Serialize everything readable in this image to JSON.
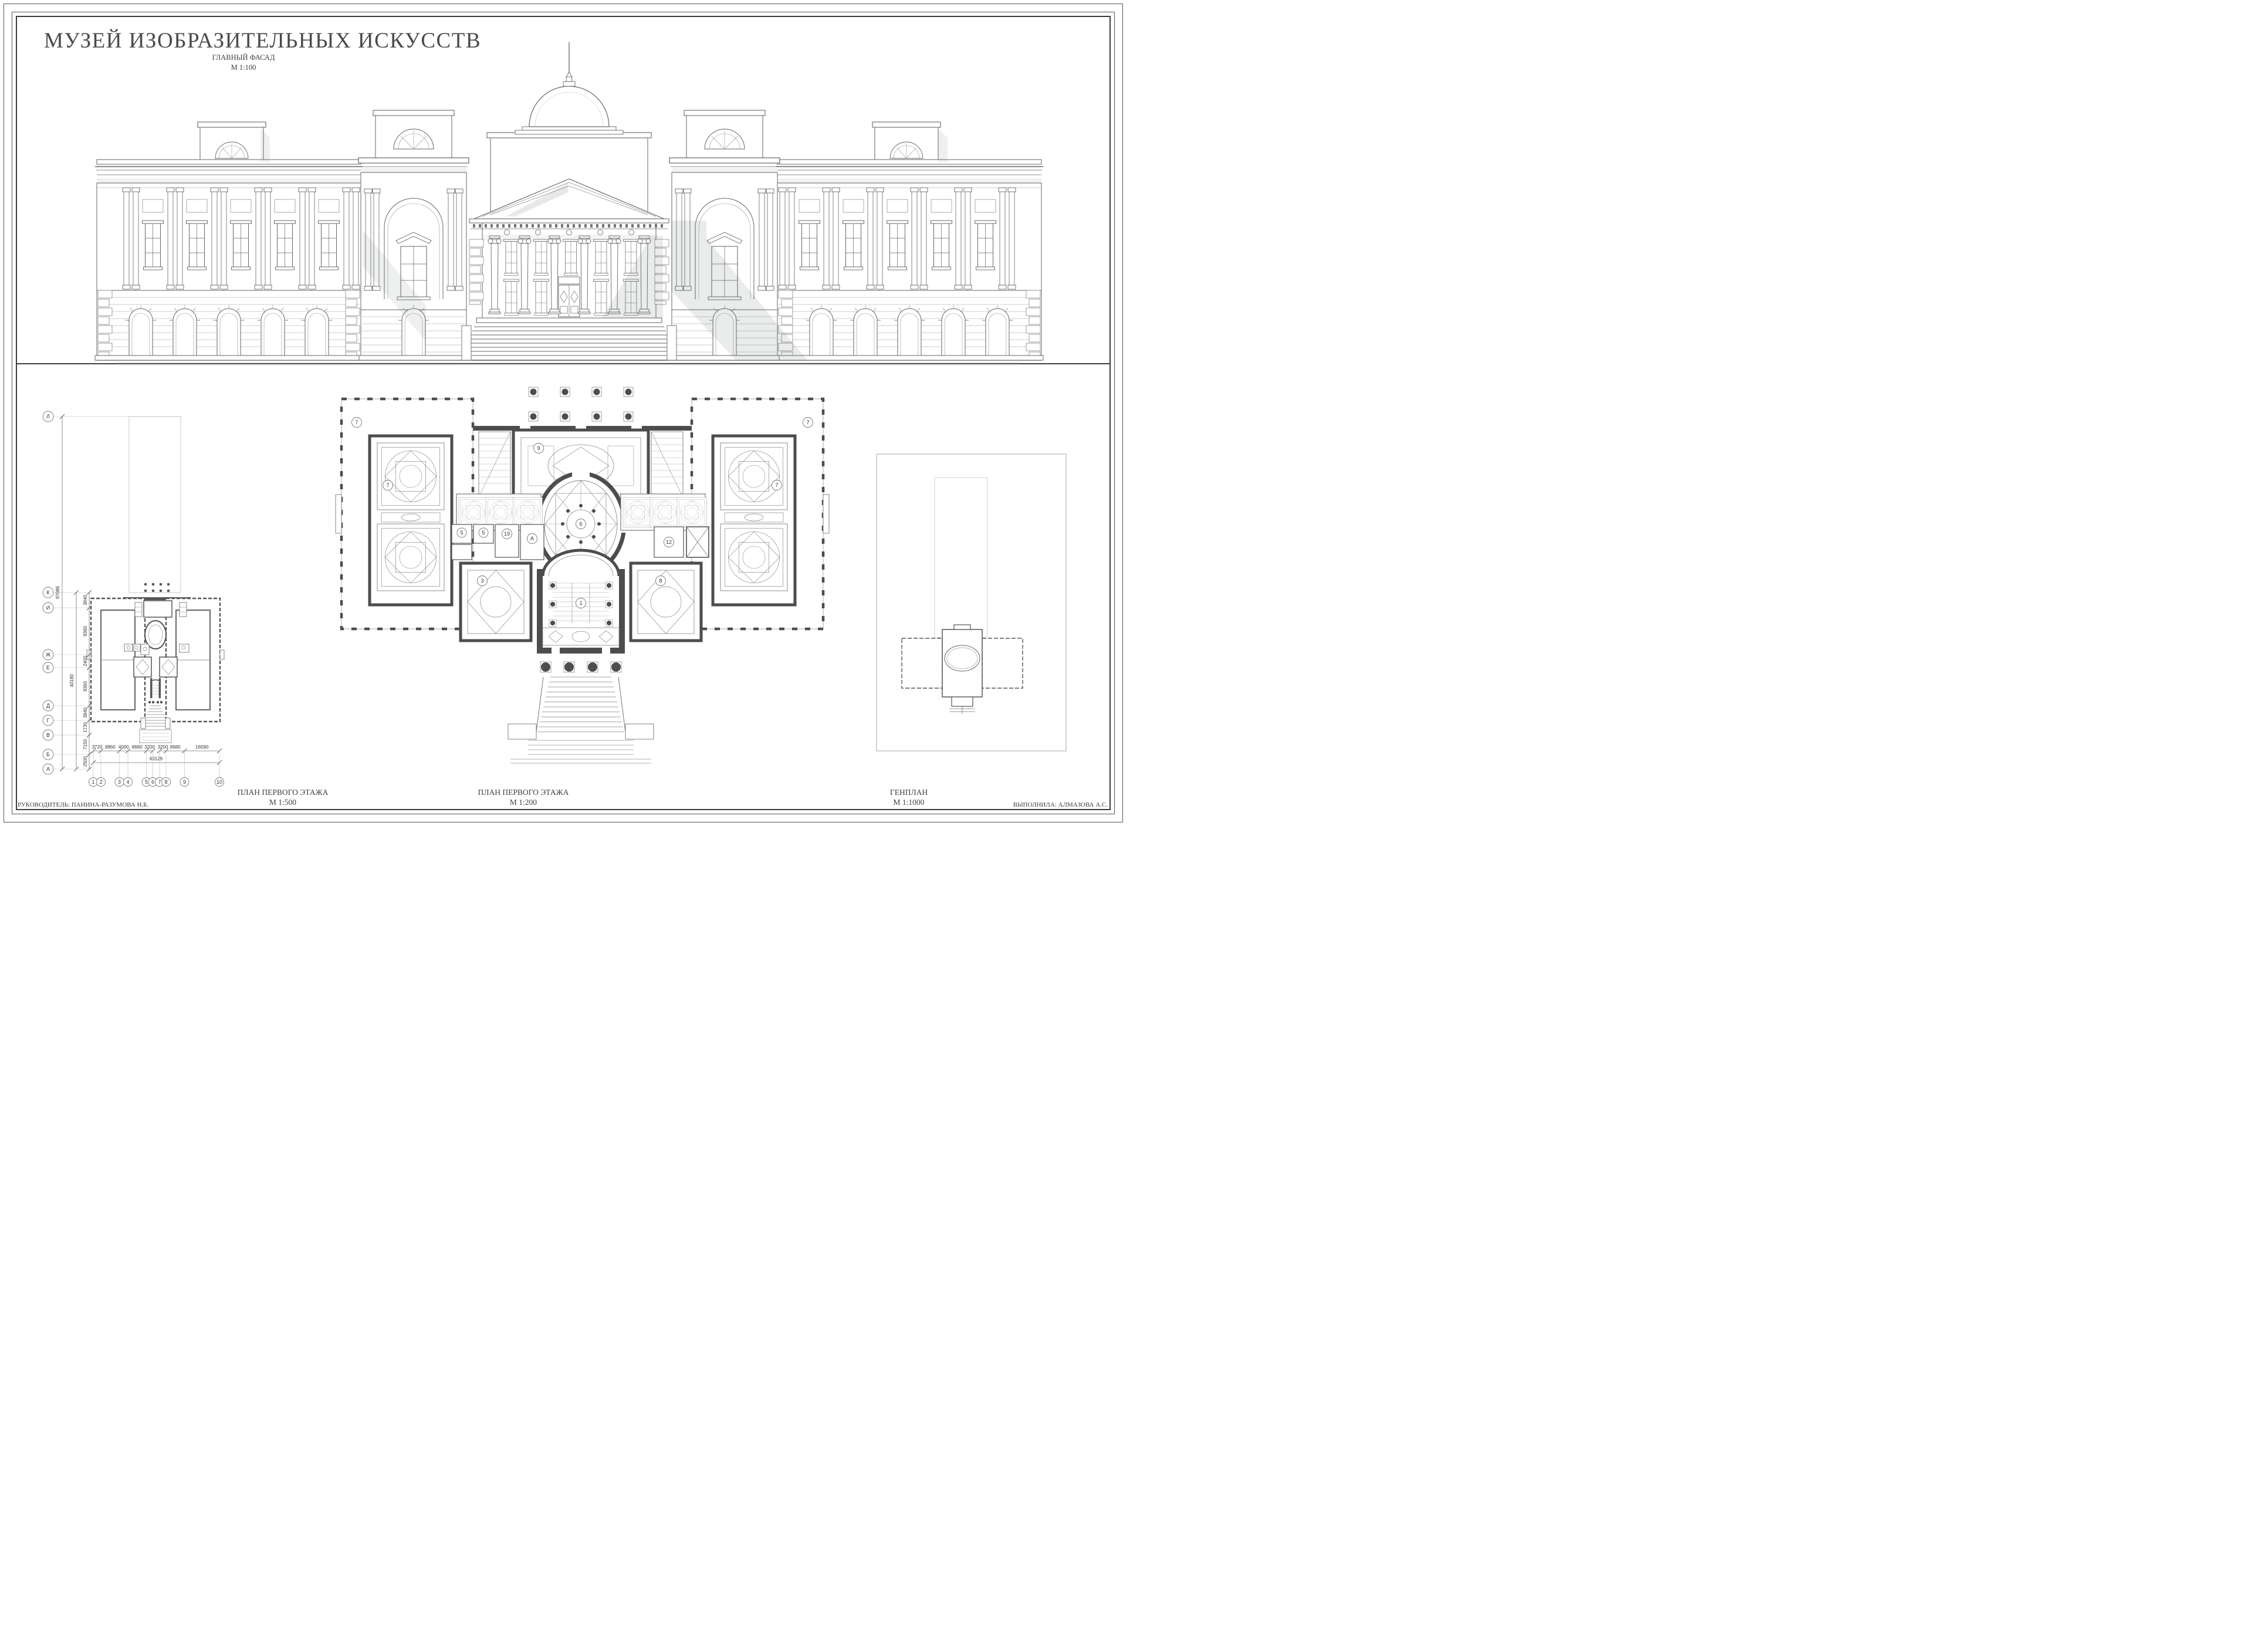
{
  "sheet": {
    "title": "МУЗЕЙ ИЗОБРАЗИТЕЛЬНЫХ ИСКУССТВ",
    "credits": {
      "supervisor": "РУКОВОДИТЕЛЬ: ПАНИНА-РАЗУМОВА Н.Б.",
      "author": "ВЫПОЛНИЛА: АЛМАЗОВА А.С."
    }
  },
  "views": {
    "facade": {
      "label": "ГЛАВНЫЙ ФАСАД",
      "scale": "М 1:100"
    },
    "plan500": {
      "label": "ПЛАН ПЕРВОГО ЭТАЖА",
      "scale": "М 1:500"
    },
    "plan200": {
      "label": "ПЛАН ПЕРВОГО ЭТАЖА",
      "scale": "М 1:200"
    },
    "genplan": {
      "label": "ГЕНПЛАН",
      "scale": "М 1:1000"
    }
  },
  "plan500": {
    "axes_vertical": [
      "Л",
      "К",
      "И",
      "Ж",
      "Е",
      "Д",
      "Г",
      "В",
      "Б",
      "А"
    ],
    "axes_horizontal": [
      "1",
      "2",
      "3",
      "4",
      "5",
      "6",
      "7",
      "8",
      "9",
      "10"
    ],
    "dims_bottom": [
      "3720",
      "8860",
      "4000",
      "8680",
      "3200",
      "3200",
      "8680",
      "16590"
    ],
    "dim_total_bottom": "60129",
    "dims_left": [
      "3840",
      "9360",
      "2400",
      "9360",
      "3840",
      "1730",
      "7150",
      "2500"
    ],
    "dim_left_total": "40180",
    "dim_overall": "97086"
  },
  "plan200": {
    "rooms": {
      "gallery_nw": "7",
      "hall_nw": "7",
      "gallery_ne": "7",
      "hall_ne": "7",
      "hall_top": "9",
      "rotunda": "6",
      "room_5a": "5",
      "room_5b": "5",
      "room_19": "19",
      "room_a": "А",
      "room_12": "12",
      "hall_sw": "3",
      "hall_se": "8",
      "vestibule": "1"
    }
  }
}
